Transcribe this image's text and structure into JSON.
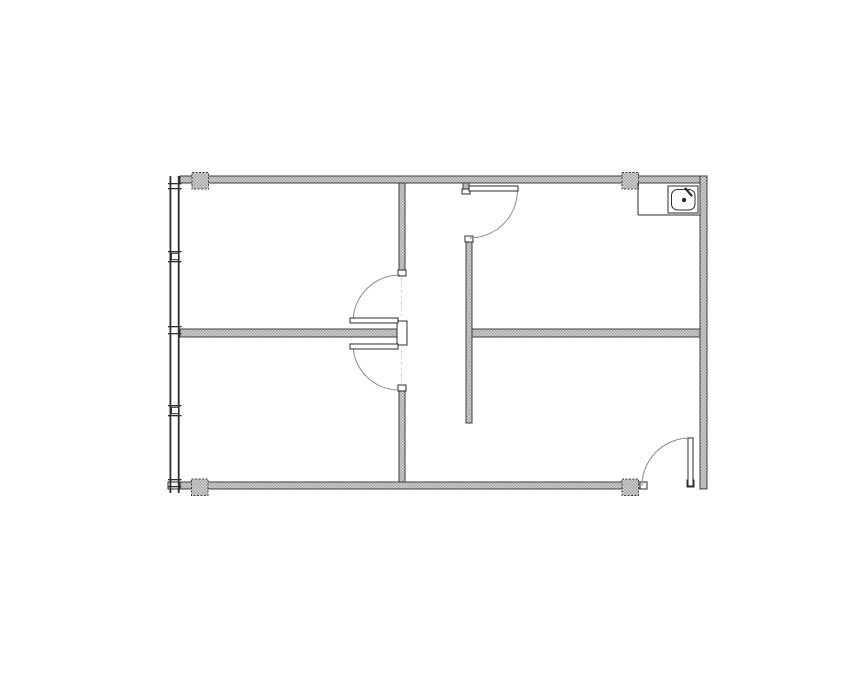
{
  "colors": {
    "background": "#ffffff",
    "wall_fill_light": "#d6d6d6",
    "wall_fill_dark": "#a2a2a2",
    "wall_stroke": "#3c3c3c",
    "line": "#2e2e2e",
    "door_leaf_fill": "#ffffff",
    "door_arc": "#8c8c8c",
    "door_centerline": "#c9dcc9",
    "fixture_fill": "#ffffff"
  },
  "plan": {
    "canvas": {
      "width": 855,
      "height": 678
    },
    "walls": [
      {
        "name": "wall-top",
        "x": 180,
        "y": 176,
        "w": 527,
        "h": 7
      },
      {
        "name": "wall-right",
        "x": 700,
        "y": 176,
        "w": 7,
        "h": 313
      },
      {
        "name": "wall-bottom",
        "x": 180,
        "y": 482,
        "w": 460,
        "h": 7
      },
      {
        "name": "wall-center-upper",
        "x": 399,
        "y": 183,
        "w": 6,
        "h": 87
      },
      {
        "name": "wall-center-lower",
        "x": 399,
        "y": 390,
        "w": 6,
        "h": 92
      },
      {
        "name": "wall-mid-left",
        "x": 180,
        "y": 329,
        "w": 218,
        "h": 8
      },
      {
        "name": "wall-mid-right",
        "x": 472,
        "y": 329,
        "w": 228,
        "h": 8
      },
      {
        "name": "wall-partition",
        "x": 466,
        "y": 241,
        "w": 6,
        "h": 182
      },
      {
        "name": "wall-entry-stub",
        "x": 463,
        "y": 183,
        "w": 6,
        "h": 6
      }
    ],
    "caps": [
      {
        "name": "jamb-bottom-left-end",
        "x": 168,
        "y": 482,
        "w": 12,
        "h": 7
      },
      {
        "name": "jamb-center-upper",
        "x": 398,
        "y": 270,
        "w": 8,
        "h": 6
      },
      {
        "name": "jamb-center",
        "x": 397,
        "y": 321,
        "w": 10,
        "h": 24
      },
      {
        "name": "jamb-center-lower",
        "x": 398,
        "y": 385,
        "w": 8,
        "h": 6
      },
      {
        "name": "jamb-partition-top",
        "x": 465,
        "y": 236,
        "w": 8,
        "h": 6
      },
      {
        "name": "jamb-entry",
        "x": 462,
        "y": 189,
        "w": 8,
        "h": 5
      },
      {
        "name": "jamb-bottom-opening",
        "x": 640,
        "y": 482,
        "w": 7,
        "h": 7
      },
      {
        "name": "jamb-door-bottom-right",
        "x": 687,
        "y": 480,
        "w": 7,
        "h": 7
      }
    ],
    "doors": [
      {
        "name": "door-entry-top",
        "leaf": {
          "x": 469,
          "y": 186,
          "w": 49,
          "h": 5
        },
        "arc": {
          "x1": 517.5,
          "y1": 191,
          "x2": 469.5,
          "y2": 238,
          "r": 48,
          "sweep": 1
        }
      },
      {
        "name": "door-center-upper",
        "leaf": {
          "x": 350,
          "y": 318,
          "w": 48,
          "h": 5
        },
        "arc": {
          "x1": 353,
          "y1": 321,
          "x2": 400,
          "y2": 275,
          "r": 47,
          "sweep": 1
        }
      },
      {
        "name": "door-center-lower",
        "leaf": {
          "x": 350,
          "y": 344,
          "w": 48,
          "h": 5
        },
        "arc": {
          "x1": 353,
          "y1": 346,
          "x2": 399,
          "y2": 390,
          "r": 46,
          "sweep": 0
        }
      },
      {
        "name": "door-bottom-right",
        "leaf": {
          "x": 688,
          "y": 438,
          "w": 5,
          "h": 48
        },
        "arc": {
          "x1": 690.5,
          "y1": 438,
          "x2": 642,
          "y2": 486,
          "r": 48,
          "sweep": 0
        }
      }
    ],
    "columns": [
      {
        "name": "column-top-left",
        "x": 192,
        "y": 172.5,
        "w": 16.5,
        "h": 16.5
      },
      {
        "name": "column-top-right",
        "x": 622,
        "y": 172.5,
        "w": 16.5,
        "h": 16.5
      },
      {
        "name": "column-bottom-left",
        "x": 191.5,
        "y": 479,
        "w": 16.5,
        "h": 16.5
      },
      {
        "name": "column-bottom-right",
        "x": 622,
        "y": 479,
        "w": 16.5,
        "h": 16.5
      }
    ],
    "window_wall": {
      "x_lines": [
        169.5,
        177.8
      ],
      "line_w": 1.8,
      "y1": 176,
      "y2": 493,
      "tick_x": 168,
      "tick_w": 13.5,
      "nub_x": 171.5,
      "nub_w": 7,
      "mullions": [
        {
          "y1": 183,
          "y2": 188,
          "nub": false
        },
        {
          "y1": 251,
          "y2": 261,
          "nub": true
        },
        {
          "y1": 326,
          "y2": 333,
          "nub": false
        },
        {
          "y1": 405,
          "y2": 415,
          "nub": true
        },
        {
          "y1": 479,
          "y2": 486,
          "nub": false
        }
      ]
    },
    "dashed_lines": [
      {
        "x": 401.5,
        "y1": 278,
        "y2": 316
      },
      {
        "x": 401.5,
        "y1": 350,
        "y2": 387
      }
    ],
    "sink": {
      "counter_left": {
        "x": 638,
        "y1": 183,
        "y2": 215
      },
      "counter_bottom": {
        "y": 215,
        "x1": 638,
        "x2": 700
      },
      "box": {
        "x": 668,
        "y": 186,
        "w": 30,
        "h": 27
      },
      "bowl": {
        "x": 671.5,
        "y": 189.5,
        "w": 23.5,
        "h": 20.5,
        "rx": 6
      },
      "drain": {
        "cx": 684,
        "cy": 200,
        "r": 2.2
      },
      "faucet": {
        "x1": 685.5,
        "y1": 188.5,
        "x2": 691.5,
        "y2": 195.5
      }
    }
  }
}
